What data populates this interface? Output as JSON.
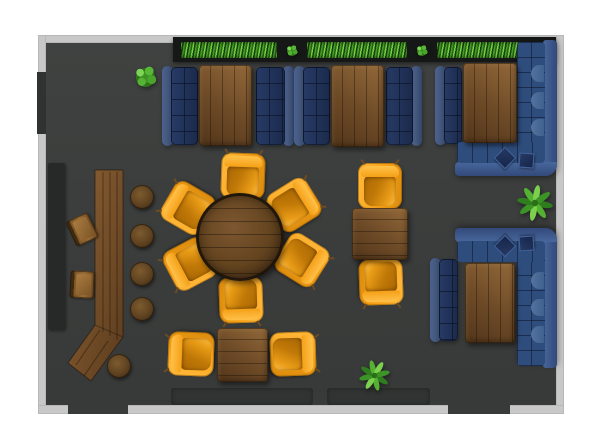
{
  "scene": {
    "title": "pub-interior-floor-plan-top-view",
    "canvas": {
      "width": 600,
      "height": 444
    }
  },
  "palette": {
    "background": "#ffffff",
    "wall": "#c8c8c8",
    "floor": "#3b3d3c",
    "opening": "#383a39",
    "window": "#303231",
    "rug": "#323433",
    "planter": "#161817",
    "counter": "#272928",
    "hedge_dark": "#1d4f10",
    "bush_dark": "#2d7618",
    "bush_light": "#7ed457",
    "navy_back": "#45597f",
    "navy_seat": "#22304f",
    "blue_back": "#48679c",
    "blue_seat": "#2f4d7c",
    "blue_bump": "#54749f",
    "pillow_edge": "#41619a",
    "wood_light": "#94693a",
    "wood_dark": "#54371b",
    "bar_light": "#8f6335",
    "bar_dark": "#5b3b1d",
    "stool": "#5d4120",
    "orange": "#f5a017",
    "orange_bright": "#ffb637",
    "orange_dark": "#c07807"
  },
  "room": {
    "floor": {
      "x": 46,
      "y": 43,
      "w": 510,
      "h": 362
    }
  },
  "items": [
    {
      "type": "floorrect",
      "name": "room-floor",
      "x": 46,
      "y": 43,
      "w": 510,
      "h": 362
    },
    {
      "type": "wall",
      "name": "wall-top",
      "x": 38,
      "y": 35,
      "w": 526,
      "h": 8
    },
    {
      "type": "wall",
      "name": "wall-left",
      "x": 38,
      "y": 35,
      "w": 8,
      "h": 379
    },
    {
      "type": "wall",
      "name": "wall-right",
      "x": 556,
      "y": 35,
      "w": 8,
      "h": 379
    },
    {
      "type": "wall",
      "name": "wall-bottom",
      "x": 38,
      "y": 405,
      "w": 526,
      "h": 9
    },
    {
      "type": "window",
      "name": "window-left-wall",
      "x": 37,
      "y": 72,
      "w": 9,
      "h": 62
    },
    {
      "type": "door",
      "name": "doorway-bottom-left",
      "x": 68,
      "y": 404,
      "w": 60,
      "h": 10
    },
    {
      "type": "door",
      "name": "doorway-bottom-right",
      "x": 448,
      "y": 399,
      "w": 62,
      "h": 15
    },
    {
      "type": "rug",
      "name": "floor-mat-left",
      "x": 171,
      "y": 388,
      "w": 142,
      "h": 17
    },
    {
      "type": "rug",
      "name": "floor-mat-right",
      "x": 327,
      "y": 388,
      "w": 103,
      "h": 17
    },
    {
      "type": "planter",
      "name": "hedge-planter-box",
      "x": 173,
      "y": 37,
      "w": 383,
      "h": 25
    },
    {
      "type": "hedge",
      "name": "hedge-1",
      "x": 181,
      "y": 42,
      "w": 96,
      "h": 16
    },
    {
      "type": "hedge",
      "name": "hedge-2",
      "x": 307,
      "y": 42,
      "w": 100,
      "h": 16
    },
    {
      "type": "hedge",
      "name": "hedge-3",
      "x": 437,
      "y": 42,
      "w": 100,
      "h": 16
    },
    {
      "type": "bush",
      "name": "planter-shrub-1",
      "x": 285,
      "y": 44,
      "w": 14,
      "h": 14
    },
    {
      "type": "bush",
      "name": "planter-shrub-2",
      "x": 415,
      "y": 44,
      "w": 14,
      "h": 14
    },
    {
      "type": "counter",
      "name": "back-bar-counter",
      "x": 48,
      "y": 163,
      "w": 17,
      "h": 167
    },
    {
      "type": "bar",
      "name": "bar-counter",
      "x": 0,
      "y": 0,
      "w": 600,
      "h": 444,
      "points": "95,170 123,170 123,337 91,381 68,363 95,325",
      "lines": [
        [
          103,
          172,
          103,
          332
        ],
        [
          110,
          172,
          110,
          336
        ],
        [
          117,
          172,
          117,
          340
        ],
        [
          100,
          330,
          76,
          365
        ],
        [
          108,
          341,
          84,
          376
        ],
        [
          95,
          325,
          123,
          337
        ]
      ]
    },
    {
      "type": "bchair",
      "name": "bar-chair-1",
      "x": 70,
      "y": 216,
      "w": 24,
      "h": 27,
      "rot": -25
    },
    {
      "type": "bchair",
      "name": "bar-chair-2",
      "x": 70,
      "y": 271,
      "w": 24,
      "h": 27,
      "rot": 3
    },
    {
      "type": "stool",
      "name": "bar-stool-1",
      "x": 130,
      "y": 185,
      "w": 24,
      "h": 24
    },
    {
      "type": "stool",
      "name": "bar-stool-2",
      "x": 130,
      "y": 224,
      "w": 24,
      "h": 24
    },
    {
      "type": "stool",
      "name": "bar-stool-3",
      "x": 130,
      "y": 262,
      "w": 24,
      "h": 24
    },
    {
      "type": "stool",
      "name": "bar-stool-4",
      "x": 130,
      "y": 297,
      "w": 24,
      "h": 24
    },
    {
      "type": "stool",
      "name": "bar-stool-5",
      "x": 107,
      "y": 354,
      "w": 24,
      "h": 24
    },
    {
      "type": "sofa",
      "name": "booth1-sofa-left",
      "variant": "side-l",
      "x": 162,
      "y": 66,
      "w": 36,
      "h": 80
    },
    {
      "type": "sofa",
      "name": "booth1-sofa-right",
      "variant": "side-r",
      "x": 256,
      "y": 66,
      "w": 38,
      "h": 80
    },
    {
      "type": "sofa",
      "name": "booth2-sofa-left",
      "variant": "side-l",
      "x": 294,
      "y": 66,
      "w": 36,
      "h": 80
    },
    {
      "type": "sofa",
      "name": "booth2-sofa-right",
      "variant": "side-r",
      "x": 386,
      "y": 66,
      "w": 36,
      "h": 80
    },
    {
      "type": "sofa",
      "name": "booth3-sofa-left",
      "variant": "side-l",
      "x": 435,
      "y": 66,
      "w": 27,
      "h": 79
    },
    {
      "type": "csofa",
      "name": "booth3-corner-sofa",
      "x": 455,
      "y": 40,
      "w": 102,
      "h": 136,
      "bumps": [
        25,
        52,
        79
      ]
    },
    {
      "type": "sofa",
      "name": "booth4-sofa-left",
      "variant": "side-l",
      "x": 430,
      "y": 258,
      "w": 28,
      "h": 84
    },
    {
      "type": "csofa",
      "name": "booth4-corner-sofa",
      "flip": true,
      "x": 455,
      "y": 228,
      "w": 102,
      "h": 140,
      "bumps": [
        25,
        52,
        79
      ]
    },
    {
      "type": "table",
      "name": "booth1-table",
      "variant": "planks-v",
      "x": 199,
      "y": 65,
      "w": 53,
      "h": 81
    },
    {
      "type": "table",
      "name": "booth2-table",
      "variant": "planks-v",
      "x": 331,
      "y": 65,
      "w": 53,
      "h": 82
    },
    {
      "type": "table",
      "name": "booth3-table",
      "variant": "planks-v",
      "x": 463,
      "y": 63,
      "w": 54,
      "h": 80
    },
    {
      "type": "table",
      "name": "booth4-table",
      "variant": "planks-v",
      "x": 465,
      "y": 263,
      "w": 50,
      "h": 80
    },
    {
      "type": "chair",
      "name": "armchair-round-top",
      "x": 221,
      "y": 153,
      "w": 44,
      "h": 46,
      "rot": 2
    },
    {
      "type": "chair",
      "name": "armchair-round-upper-right",
      "x": 272,
      "y": 182,
      "w": 44,
      "h": 46,
      "rot": 58
    },
    {
      "type": "chair",
      "name": "armchair-round-lower-right",
      "x": 280,
      "y": 237,
      "w": 44,
      "h": 46,
      "rot": 122
    },
    {
      "type": "chair",
      "name": "armchair-round-bottom",
      "x": 219,
      "y": 277,
      "w": 44,
      "h": 46,
      "rot": 178
    },
    {
      "type": "chair",
      "name": "armchair-round-lower-left",
      "x": 168,
      "y": 241,
      "w": 44,
      "h": 46,
      "rot": 242
    },
    {
      "type": "chair",
      "name": "armchair-round-upper-left",
      "x": 166,
      "y": 185,
      "w": 44,
      "h": 46,
      "rot": 300
    },
    {
      "type": "chair",
      "name": "armchair-right-table-top",
      "x": 358,
      "y": 163,
      "w": 44,
      "h": 46,
      "rot": 0
    },
    {
      "type": "chair",
      "name": "armchair-right-table-bottom",
      "x": 359,
      "y": 259,
      "w": 44,
      "h": 46,
      "rot": 178
    },
    {
      "type": "chair",
      "name": "armchair-bottom-table-left",
      "x": 169,
      "y": 331,
      "w": 44,
      "h": 46,
      "rot": 272
    },
    {
      "type": "chair",
      "name": "armchair-bottom-table-right",
      "x": 271,
      "y": 331,
      "w": 44,
      "h": 46,
      "rot": 88
    },
    {
      "type": "rtable",
      "name": "round-dining-table",
      "x": 196,
      "y": 193,
      "w": 88,
      "h": 88
    },
    {
      "type": "table",
      "name": "dining-table-right",
      "variant": "planks-h",
      "x": 352,
      "y": 208,
      "w": 56,
      "h": 52
    },
    {
      "type": "table",
      "name": "dining-table-bottom",
      "variant": "planks-h",
      "x": 217,
      "y": 328,
      "w": 51,
      "h": 54
    },
    {
      "type": "bush",
      "name": "potted-shrub-large",
      "x": 132,
      "y": 64,
      "w": 27,
      "h": 27
    },
    {
      "type": "plant",
      "name": "potted-plant-right",
      "x": 517,
      "y": 185,
      "w": 36,
      "h": 36,
      "seed": 10
    },
    {
      "type": "plant",
      "name": "potted-plant-bottom",
      "x": 359,
      "y": 360,
      "w": 31,
      "h": 31,
      "seed": 32
    }
  ]
}
